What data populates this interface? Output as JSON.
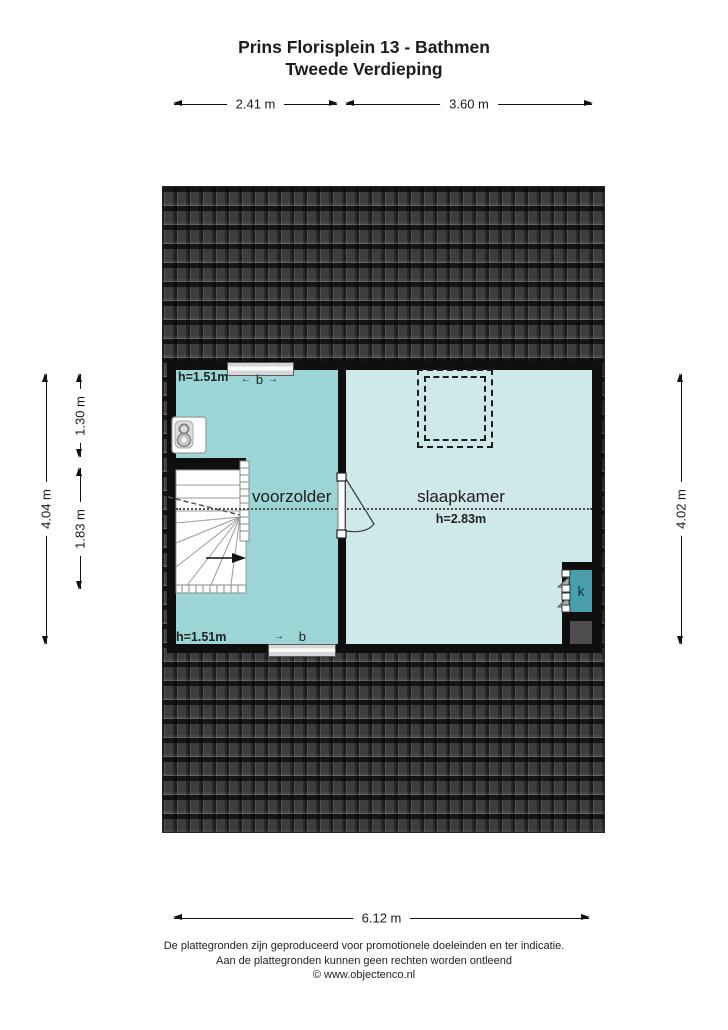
{
  "title": {
    "line1": "Prins Florisplein 13 - Bathmen",
    "line2": "Tweede Verdieping"
  },
  "dimensions": {
    "top_left": "2.41 m",
    "top_right": "3.60 m",
    "left_outer": "4.04 m",
    "left_inner_top": "1.30 m",
    "left_inner_bottom": "1.83 m",
    "right": "4.02 m",
    "bottom": "6.12 m"
  },
  "rooms": {
    "voorzolder": {
      "label": "voorzolder",
      "height_label_top": "h=1.51m",
      "height_label_bottom": "h=1.51m"
    },
    "slaapkamer": {
      "label": "slaapkamer",
      "height_label": "h=2.83m"
    },
    "closet": {
      "label": "k"
    }
  },
  "marks": {
    "top_b": {
      "left_arrow": "←",
      "label": "b",
      "right_arrow": "→"
    },
    "bottom_b": {
      "arrow": "→",
      "label": "b"
    }
  },
  "footer": {
    "line1": "De plattegronden zijn geproduceerd voor promotionele doeleinden en ter indicatie.",
    "line2": "Aan de plattegronden kunnen geen rechten worden ontleend",
    "line3": "© www.objectenco.nl"
  },
  "colors": {
    "wall": "#0f0f0f",
    "roof_base": "#3d3d3d",
    "voorzolder_fill": "#9cd5d6",
    "slaapkamer_fill": "#cfe9ea",
    "closet_fill": "#4a9fae",
    "shaft_fill": "#4e4e4e"
  }
}
